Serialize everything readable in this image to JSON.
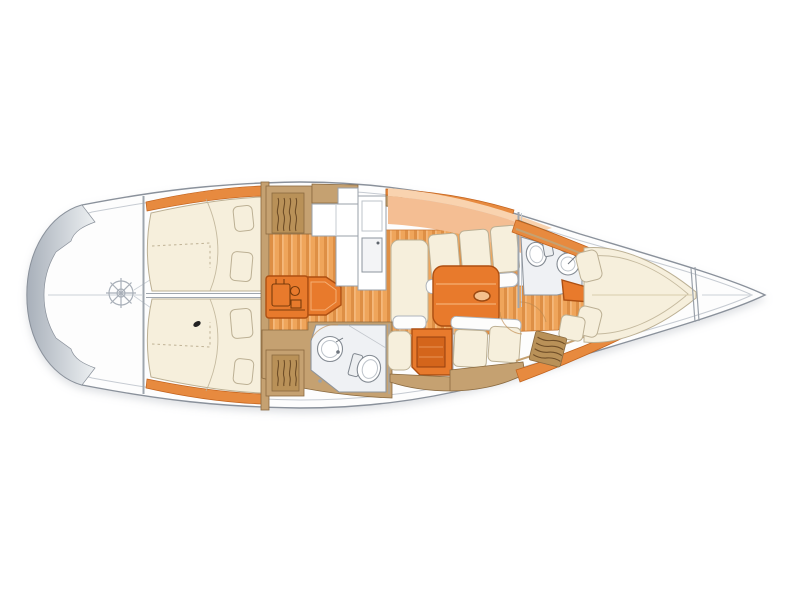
{
  "diagram": {
    "type": "sailboat-interior-deck-plan",
    "title": "Sailing yacht interior layout, top view, bow to the right",
    "orientation": "bow-right",
    "zones": [
      "cockpit",
      "helm-wheel",
      "aft-cabin-port",
      "aft-cabin-starboard",
      "companionway-engine",
      "companionway-steps",
      "galley",
      "salon-settee-port",
      "salon-settee-starboard",
      "dining-table",
      "nav-station",
      "aft-head",
      "forward-head",
      "forward-cabin-v-berth",
      "bow-locker",
      "side-deck-stripes",
      "louvered-lockers"
    ]
  },
  "canvas": {
    "width": 800,
    "height": 600,
    "background": "#FFFFFF"
  },
  "colors": {
    "hull_fill": "#FDFDFD",
    "hull_stroke": "#8A919B",
    "deck_line": "#C6CBD2",
    "transom_dark": "#A8B0BA",
    "transom_light": "#EDF0F2",
    "centerline": "#D5DADF",
    "wheel": "#A8AFB8",
    "cushion": "#F6EFDC",
    "cushion_stroke": "#BCB094",
    "wood_base": "#EFA55B",
    "wood_stripe": "#DE8F45",
    "wood_light": "#F7BF85",
    "wood_border": "#C8742E",
    "accent": "#E87A2C",
    "accent_dark": "#AD4F12",
    "accent_inner": "#D4651B",
    "stripe": "#E78A3F",
    "stripe_dark": "#C2621C",
    "peach": "#F4BE93",
    "peach_light": "#F9D3AF",
    "tan": "#C5A171",
    "tan_dark": "#8A6A40",
    "tan_hatch": "#B99158",
    "louver": "#6F4E28",
    "fixture_fill": "#FFFFFF",
    "fixture_stroke": "#848B93",
    "head_floor": "#EFF1F4",
    "head_stroke": "#8E959D",
    "engine_detail": "#6E3509",
    "divider": "#9FA6AE",
    "mark_dark": "#222222"
  }
}
